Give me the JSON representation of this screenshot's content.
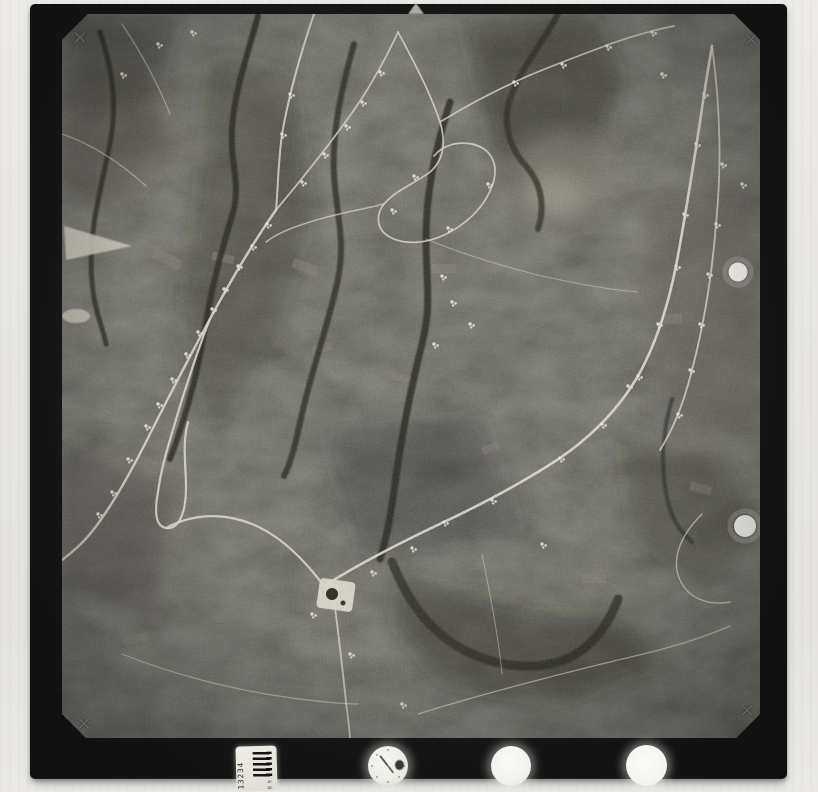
{
  "scene": {
    "kind": "aerial-photograph-film-frame-scan",
    "background_color": "#e8e7e4",
    "film_frame_color": "#161616",
    "photo_dark_tone": "#34332d",
    "photo_light_tone": "#dcd9cc"
  },
  "marks": {
    "cross": "×"
  },
  "data_strip": {
    "barcode": {
      "number": "13234",
      "small_text": "B 9"
    }
  }
}
